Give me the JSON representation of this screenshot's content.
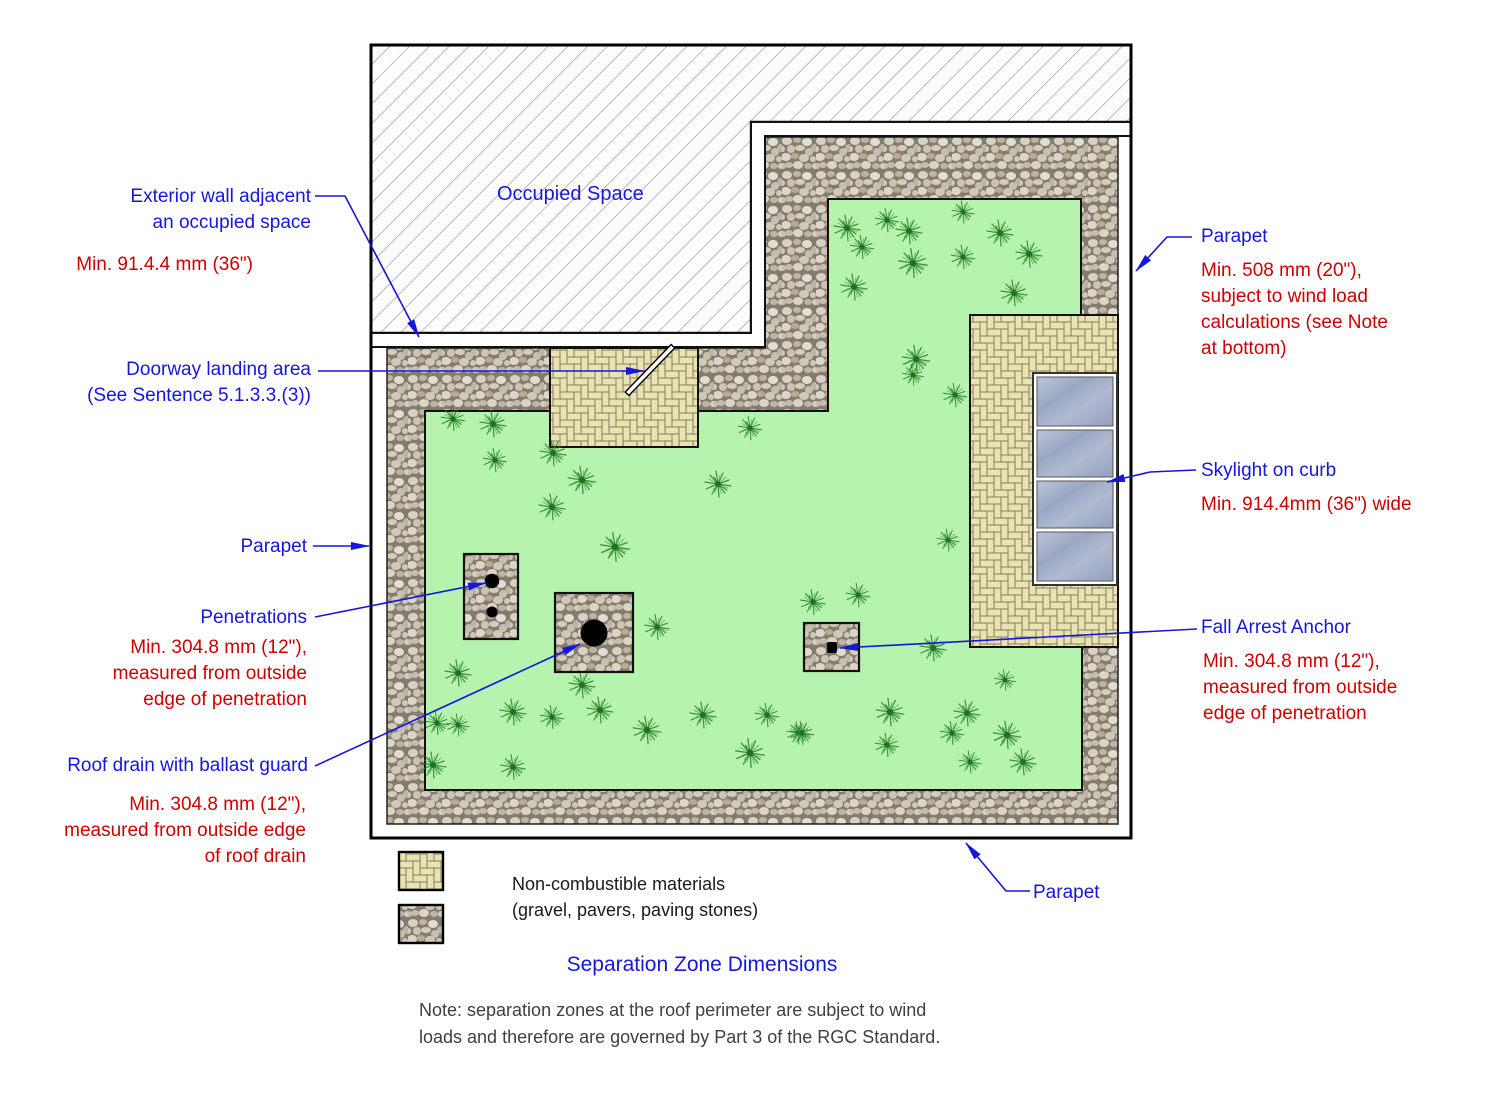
{
  "diagram": {
    "title": "Separation Zone Dimensions",
    "occupied_space": "Occupied Space",
    "legend": {
      "line1": "Non-combustible materials",
      "line2": "(gravel, pavers, paving stones)"
    },
    "note": [
      "Note: separation zones at the roof perimeter are subject to wind",
      "loads and therefore are governed by Part 3 of the RGC Standard."
    ],
    "annotations": {
      "exterior_wall": {
        "label": [
          "Exterior wall adjacent",
          "an occupied space"
        ],
        "dim": "Min. 91.4.4 mm (36\")"
      },
      "doorway": {
        "label": [
          "Doorway landing area",
          "(See Sentence 5.1.3.3.(3))"
        ]
      },
      "parapet_left": {
        "label": "Parapet"
      },
      "penetrations": {
        "label": "Penetrations",
        "dim": [
          "Min. 304.8 mm (12\"),",
          "measured from outside",
          "edge of penetration"
        ]
      },
      "roof_drain": {
        "label": "Roof drain with ballast guard",
        "dim": [
          "Min. 304.8 mm (12\"),",
          "measured from outside edge",
          "of roof drain"
        ]
      },
      "parapet_right": {
        "label": "Parapet",
        "dim": [
          "Min. 508 mm (20\"),",
          "subject to wind load",
          "calculations (see Note",
          "at bottom)"
        ]
      },
      "skylight": {
        "label": "Skylight on curb",
        "dim": "Min. 914.4mm (36\") wide"
      },
      "fall_arrest": {
        "label": "Fall Arrest Anchor",
        "dim": [
          "Min. 304.8 mm (12\"),",
          "measured from outside",
          "edge of penetration"
        ]
      },
      "parapet_bottom": {
        "label": "Parapet"
      }
    },
    "colors": {
      "label_blue": "#1616dd",
      "dim_red": "#cc0000",
      "vegetated_green": "#b5f3ae",
      "paver_tan": "#e9e3b4",
      "gravel_joint": "#837d6f",
      "skylight_glass": "#a4b0ca",
      "note_gray": "#3f3f3f"
    },
    "plants": [
      [
        847,
        228,
        1
      ],
      [
        887,
        220,
        0.9
      ],
      [
        909,
        231,
        1
      ],
      [
        963,
        212,
        0.85
      ],
      [
        1000,
        233,
        1
      ],
      [
        862,
        247,
        0.9
      ],
      [
        913,
        263,
        1.1
      ],
      [
        963,
        257,
        0.9
      ],
      [
        1029,
        254,
        1
      ],
      [
        854,
        287,
        1
      ],
      [
        1014,
        293,
        1
      ],
      [
        916,
        359,
        1.05
      ],
      [
        913,
        375,
        0.8
      ],
      [
        955,
        395,
        0.9
      ],
      [
        948,
        540,
        0.85
      ],
      [
        453,
        419,
        0.9
      ],
      [
        493,
        424,
        1
      ],
      [
        495,
        460,
        0.9
      ],
      [
        553,
        453,
        1
      ],
      [
        582,
        480,
        1.05
      ],
      [
        552,
        507,
        1
      ],
      [
        750,
        428,
        0.9
      ],
      [
        718,
        484,
        1
      ],
      [
        615,
        547,
        1.1
      ],
      [
        657,
        627,
        0.95
      ],
      [
        458,
        673,
        1
      ],
      [
        582,
        685,
        1
      ],
      [
        437,
        723,
        0.9
      ],
      [
        458,
        725,
        0.85
      ],
      [
        513,
        712,
        1
      ],
      [
        552,
        717,
        0.9
      ],
      [
        600,
        710,
        1
      ],
      [
        647,
        730,
        1.05
      ],
      [
        703,
        715,
        1
      ],
      [
        767,
        715,
        0.9
      ],
      [
        798,
        733,
        0.85
      ],
      [
        433,
        765,
        1
      ],
      [
        513,
        767,
        0.95
      ],
      [
        750,
        753,
        1.1
      ],
      [
        813,
        602,
        0.95
      ],
      [
        858,
        595,
        0.9
      ],
      [
        933,
        648,
        1
      ],
      [
        1005,
        680,
        0.8
      ],
      [
        890,
        712,
        1.05
      ],
      [
        967,
        713,
        1
      ],
      [
        952,
        733,
        0.9
      ],
      [
        1007,
        735,
        1.05
      ],
      [
        887,
        745,
        0.9
      ],
      [
        970,
        762,
        0.85
      ],
      [
        1023,
        762,
        1
      ],
      [
        802,
        733,
        0.9
      ]
    ]
  }
}
